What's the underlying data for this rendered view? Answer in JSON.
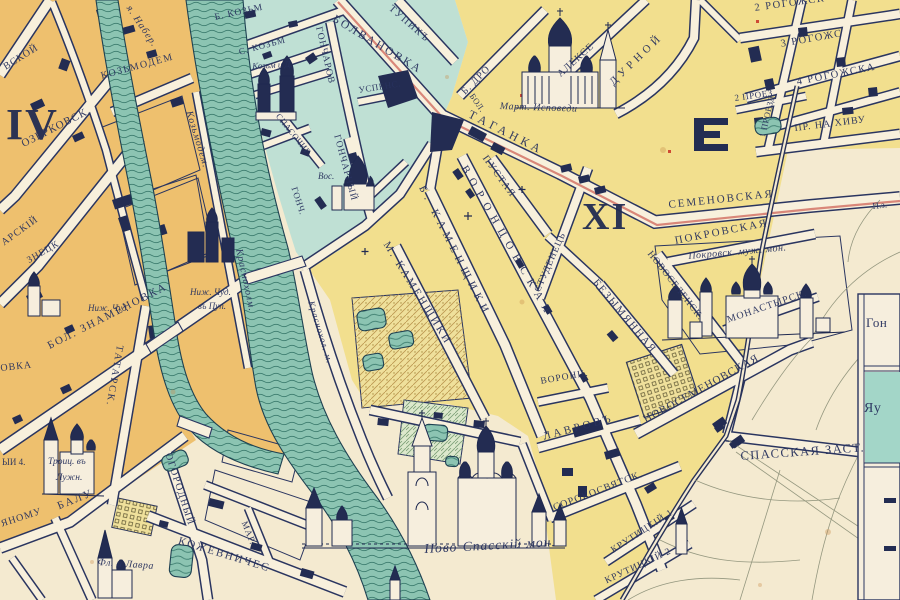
{
  "map": {
    "kind": "historic city plan",
    "districts_visible": [
      "IV",
      "XI"
    ],
    "colors": {
      "paper": "#f4ead0",
      "street": "#f8f0dc",
      "ink": "#28325e",
      "district_iv_fill": "#eec06e",
      "district_xi_fill": "#f2df8e",
      "district_teal_fill": "#bfe0d4",
      "water": "#8cc4b2",
      "highway_red": "#d98779",
      "garden_hatch": "#bb9750"
    },
    "inset": {
      "rows": [
        "Гон",
        "Яу"
      ]
    },
    "labels": [
      {
        "id": "numeral-iv",
        "text": "IV",
        "x": 6,
        "y": 103,
        "rot": 0,
        "size": 44,
        "sp": 2,
        "style": "num"
      },
      {
        "id": "numeral-xi",
        "text": "XI",
        "x": 582,
        "y": 198,
        "rot": 0,
        "size": 38,
        "sp": 2,
        "style": "num"
      },
      {
        "id": "frag-vskoy",
        "text": "ВСКОЙ",
        "x": 2,
        "y": 64,
        "rot": -32,
        "size": 10,
        "sp": 1,
        "style": "caps"
      },
      {
        "id": "ozerkovsk",
        "text": "ОЗЕРКОВСК.",
        "x": 20,
        "y": 140,
        "rot": -27,
        "size": 11,
        "sp": 1,
        "style": "caps"
      },
      {
        "id": "kozmodem",
        "text": "КОЗЬМОДЕМ",
        "x": 100,
        "y": 72,
        "rot": -15,
        "size": 10,
        "sp": 1.5,
        "style": "caps"
      },
      {
        "id": "naber",
        "text": "я. Набер.",
        "x": 132,
        "y": 4,
        "rot": 56,
        "size": 10,
        "sp": 1,
        "style": "it"
      },
      {
        "id": "river-kozmodem",
        "text": "Козьмодем.",
        "x": 193,
        "y": 110,
        "rot": 73,
        "size": 10,
        "sp": 1,
        "style": "it"
      },
      {
        "id": "river-krasnokholm",
        "text": "Краснохолм.",
        "x": 243,
        "y": 248,
        "rot": 78,
        "size": 10,
        "sp": 1,
        "style": "it"
      },
      {
        "id": "river-krasnokholm2",
        "text": "Краснохол. м.",
        "x": 315,
        "y": 300,
        "rot": 73,
        "size": 9,
        "sp": 1,
        "style": "it"
      },
      {
        "id": "frag-arskiy",
        "text": "АРСКIЙ",
        "x": 0,
        "y": 240,
        "rot": -36,
        "size": 10,
        "sp": 1,
        "style": "caps"
      },
      {
        "id": "frag-znetsk",
        "text": "ЗНЕЦК",
        "x": 26,
        "y": 258,
        "rot": -30,
        "size": 9.5,
        "sp": 1,
        "style": "caps"
      },
      {
        "id": "znamenovka",
        "text": "БОЛ. ЗНАМЕНОВКА",
        "x": 46,
        "y": 342,
        "rot": -27,
        "size": 11,
        "sp": 2,
        "style": "caps"
      },
      {
        "id": "tatarsk",
        "text": "ТАТАРСК.",
        "x": 124,
        "y": 346,
        "rot": 100,
        "size": 10,
        "sp": 2,
        "style": "caps"
      },
      {
        "id": "nizh-chud-1",
        "text": "Ниж. Чуд.",
        "x": 88,
        "y": 304,
        "rot": 0,
        "size": 9,
        "sp": 0,
        "style": "it"
      },
      {
        "id": "nizh-chud-2",
        "text": "Ниж. Чуд.",
        "x": 190,
        "y": 288,
        "rot": 0,
        "size": 9,
        "sp": 0,
        "style": "it"
      },
      {
        "id": "v-pup",
        "text": "въ Пуп.",
        "x": 198,
        "y": 302,
        "rot": 0,
        "size": 9,
        "sp": 0,
        "style": "it"
      },
      {
        "id": "troits",
        "text": "Троиц. въ",
        "x": 48,
        "y": 458,
        "rot": 0,
        "size": 9.5,
        "sp": 0,
        "style": "it"
      },
      {
        "id": "luzhn",
        "text": "Лужн.",
        "x": 56,
        "y": 474,
        "rot": 0,
        "size": 9.5,
        "sp": 0,
        "style": "it"
      },
      {
        "id": "frag-yi4",
        "text": "ЫИ 4.",
        "x": 2,
        "y": 458,
        "rot": 0,
        "size": 9,
        "sp": 0,
        "style": "caps"
      },
      {
        "id": "frag-ovka",
        "text": "ОВКА",
        "x": 0,
        "y": 364,
        "rot": -6,
        "size": 10,
        "sp": 1,
        "style": "caps"
      },
      {
        "id": "yanomu",
        "text": "ЯНОМУ",
        "x": 0,
        "y": 520,
        "rot": -18,
        "size": 10,
        "sp": 1,
        "style": "caps"
      },
      {
        "id": "balu",
        "text": "БАЛУ",
        "x": 56,
        "y": 502,
        "rot": -22,
        "size": 11,
        "sp": 2,
        "style": "caps"
      },
      {
        "id": "ogorodny",
        "text": "ОГОРОДНЫЙ",
        "x": 172,
        "y": 452,
        "rot": 72,
        "size": 10,
        "sp": 1.5,
        "style": "caps"
      },
      {
        "id": "kozhevnich",
        "text": "КОЖЕВНИЧЕС",
        "x": 180,
        "y": 536,
        "rot": 17,
        "size": 11,
        "sp": 2,
        "style": "caps"
      },
      {
        "id": "mar",
        "text": "МАР.",
        "x": 248,
        "y": 520,
        "rot": 68,
        "size": 9,
        "sp": 1,
        "style": "caps"
      },
      {
        "id": "fl-lavra",
        "text": "Фл. и Лавра",
        "x": 98,
        "y": 558,
        "rot": 4,
        "size": 10,
        "sp": 0.5,
        "style": "it"
      },
      {
        "id": "b-kozm",
        "text": "Б. КОЗЬМ",
        "x": 214,
        "y": 14,
        "rot": -12,
        "size": 9.5,
        "sp": 1,
        "style": "caps"
      },
      {
        "id": "s-kozm",
        "text": "С. КОЗЬМ",
        "x": 238,
        "y": 48,
        "rot": -15,
        "size": 9,
        "sp": 1,
        "style": "caps"
      },
      {
        "id": "kozm-d",
        "text": "Козьм и Д.",
        "x": 252,
        "y": 62,
        "rot": -3,
        "size": 9,
        "sp": 0,
        "style": "it"
      },
      {
        "id": "goncharov",
        "text": "ГОНЧАРОВ",
        "x": 322,
        "y": 26,
        "rot": 77,
        "size": 9.5,
        "sp": 1,
        "style": "caps"
      },
      {
        "id": "bolvanovka",
        "text": "БОЛВАНОВКА",
        "x": 336,
        "y": 14,
        "rot": 31,
        "size": 11.5,
        "sp": 2.5,
        "style": "caps"
      },
      {
        "id": "tupik",
        "text": "ТУПИКЪ",
        "x": 393,
        "y": 4,
        "rot": 41,
        "size": 10,
        "sp": 1.5,
        "style": "caps"
      },
      {
        "id": "spasochig",
        "text": "СПАСОЧИГ.",
        "x": 281,
        "y": 112,
        "rot": 51,
        "size": 8.5,
        "sp": 0.5,
        "style": "caps"
      },
      {
        "id": "uspens",
        "text": "УСПЕНС.",
        "x": 358,
        "y": 86,
        "rot": -9,
        "size": 9,
        "sp": 0.5,
        "style": "caps"
      },
      {
        "id": "goncharny",
        "text": "ГОНЧАРНЫЙ",
        "x": 340,
        "y": 134,
        "rot": 75,
        "size": 9.5,
        "sp": 1,
        "style": "caps"
      },
      {
        "id": "vos",
        "text": "Вос.",
        "x": 318,
        "y": 172,
        "rot": 0,
        "size": 9,
        "sp": 0,
        "style": "it"
      },
      {
        "id": "gonch",
        "text": "ГОНЧ.",
        "x": 298,
        "y": 186,
        "rot": 72,
        "size": 9,
        "sp": 0.5,
        "style": "caps"
      },
      {
        "id": "b-dro",
        "text": "Б. ДРО",
        "x": 460,
        "y": 90,
        "rot": -45,
        "size": 10,
        "sp": 1,
        "style": "caps"
      },
      {
        "id": "bol",
        "text": "БОЛ.",
        "x": 475,
        "y": 92,
        "rot": 55,
        "size": 8.5,
        "sp": 0.5,
        "style": "caps"
      },
      {
        "id": "taganka",
        "text": "ТАГАНКА",
        "x": 472,
        "y": 108,
        "rot": 27,
        "size": 12,
        "sp": 4,
        "style": "caps"
      },
      {
        "id": "mart-ispovedi",
        "text": "Март. Исповеди",
        "x": 500,
        "y": 102,
        "rot": 2,
        "size": 10,
        "sp": 0.5,
        "style": "it"
      },
      {
        "id": "alekse",
        "text": "АЛЕКСЕ",
        "x": 556,
        "y": 72,
        "rot": -42,
        "size": 10,
        "sp": 1,
        "style": "caps"
      },
      {
        "id": "durnoy",
        "text": "ДУРНОЙ",
        "x": 608,
        "y": 80,
        "rot": -44,
        "size": 11,
        "sp": 4,
        "style": "caps"
      },
      {
        "id": "rogozh2",
        "text": "2 РОГОЖСК",
        "x": 754,
        "y": 4,
        "rot": -8,
        "size": 10.5,
        "sp": 1.5,
        "style": "caps"
      },
      {
        "id": "proezd1",
        "text": "1 ПРОЕЗД.",
        "x": 758,
        "y": 136,
        "rot": -77,
        "size": 8.5,
        "sp": 0.5,
        "style": "caps"
      },
      {
        "id": "rogozh3",
        "text": "3 РОГОЖС",
        "x": 780,
        "y": 40,
        "rot": -10,
        "size": 10.5,
        "sp": 1.5,
        "style": "caps"
      },
      {
        "id": "proez2",
        "text": "2 ПРОЕЗ.",
        "x": 734,
        "y": 94,
        "rot": -8,
        "size": 9,
        "sp": 0.5,
        "style": "caps"
      },
      {
        "id": "rogozh4",
        "text": "4 РОГОЖСКА",
        "x": 796,
        "y": 78,
        "rot": -11,
        "size": 10.5,
        "sp": 1.5,
        "style": "caps"
      },
      {
        "id": "khiva",
        "text": "ПР. НА ХИВУ",
        "x": 794,
        "y": 124,
        "rot": -7,
        "size": 10,
        "sp": 1,
        "style": "caps"
      },
      {
        "id": "pustaya",
        "text": "ПУСТАЯ",
        "x": 488,
        "y": 154,
        "rot": 54,
        "size": 10,
        "sp": 1.5,
        "style": "caps"
      },
      {
        "id": "studenets",
        "text": "СТУДЕНЕЦЬ",
        "x": 534,
        "y": 290,
        "rot": -66,
        "size": 9.5,
        "sp": 1,
        "style": "caps"
      },
      {
        "id": "semenovskaya",
        "text": "СЕМЕНОВСКАЯ",
        "x": 668,
        "y": 200,
        "rot": -6,
        "size": 11,
        "sp": 2,
        "style": "caps"
      },
      {
        "id": "frag-pz",
        "text": "П.з.",
        "x": 872,
        "y": 202,
        "rot": -6,
        "size": 9,
        "sp": 0,
        "style": "caps"
      },
      {
        "id": "vorontsovskaya",
        "text": "ВОРОНЦОВСКАЯ",
        "x": 468,
        "y": 164,
        "rot": 60,
        "size": 11,
        "sp": 7,
        "style": "caps"
      },
      {
        "id": "b-kamenshchiki",
        "text": "Б. КАМЕНЩИКИ",
        "x": 426,
        "y": 184,
        "rot": 63,
        "size": 11,
        "sp": 5,
        "style": "caps"
      },
      {
        "id": "m-kamenshchiki",
        "text": "М. КАМЕНЩИКИ",
        "x": 390,
        "y": 240,
        "rot": 58,
        "size": 11,
        "sp": 2.5,
        "style": "caps"
      },
      {
        "id": "pokrovskaya",
        "text": "ПОКРОВСКАЯ",
        "x": 674,
        "y": 236,
        "rot": -11,
        "size": 11,
        "sp": 2,
        "style": "caps"
      },
      {
        "id": "pokrovsk-mon",
        "text": "Покровск. муж. мон.",
        "x": 688,
        "y": 252,
        "rot": -5,
        "size": 10,
        "sp": 0.5,
        "style": "it"
      },
      {
        "id": "novoselensk",
        "text": "НОВОСЕЛЕНСК.",
        "x": 652,
        "y": 250,
        "rot": 52,
        "size": 9.5,
        "sp": 1,
        "style": "caps"
      },
      {
        "id": "bezymyannaya",
        "text": "БЕЗЫМЯННАЯ",
        "x": 598,
        "y": 278,
        "rot": 50,
        "size": 10.5,
        "sp": 2,
        "style": "caps"
      },
      {
        "id": "monastyrsk",
        "text": "МОНАСТЫРСК.",
        "x": 726,
        "y": 316,
        "rot": -19,
        "size": 10,
        "sp": 1,
        "style": "caps"
      },
      {
        "id": "novosemenovskaya",
        "text": "НОВОСЕМЕНОВСКАЯ",
        "x": 642,
        "y": 416,
        "rot": -29,
        "size": 11,
        "sp": 1,
        "style": "caps"
      },
      {
        "id": "voronts",
        "text": "ВОРОНЦ.",
        "x": 540,
        "y": 378,
        "rot": -10,
        "size": 9.5,
        "sp": 1,
        "style": "caps"
      },
      {
        "id": "lavrov",
        "text": "ЛАВРОВЪ",
        "x": 542,
        "y": 432,
        "rot": -15,
        "size": 11,
        "sp": 3,
        "style": "caps"
      },
      {
        "id": "sorokosvyatsk",
        "text": "СОРОКОСВЯТСК.",
        "x": 552,
        "y": 504,
        "rot": -21,
        "size": 10,
        "sp": 1,
        "style": "caps"
      },
      {
        "id": "krutitsky1",
        "text": "КРУТИЦКIЙ 1",
        "x": 610,
        "y": 548,
        "rot": -33,
        "size": 9.5,
        "sp": 1,
        "style": "caps"
      },
      {
        "id": "krutitsky2",
        "text": "КРУТИЦКIЙ 2",
        "x": 604,
        "y": 578,
        "rot": -25,
        "size": 9.5,
        "sp": 1,
        "style": "caps"
      },
      {
        "id": "spasskaya-zast",
        "text": "СПАССКАЯ ЗАСТ.",
        "x": 740,
        "y": 450,
        "rot": -4,
        "size": 12.5,
        "sp": 1.5,
        "style": "caps"
      },
      {
        "id": "novospassky",
        "text": "Ново-Спасскій мон.",
        "x": 424,
        "y": 542,
        "rot": -3,
        "size": 13.5,
        "sp": 1,
        "style": "it"
      },
      {
        "id": "inset-gon",
        "text": "Гон",
        "x": 866,
        "y": 316,
        "rot": 0,
        "size": 13,
        "sp": 0.5,
        "style": "caps"
      },
      {
        "id": "inset-yau",
        "text": "Яу",
        "x": 864,
        "y": 402,
        "rot": 0,
        "size": 14,
        "sp": 0.5,
        "style": "caps"
      }
    ]
  }
}
